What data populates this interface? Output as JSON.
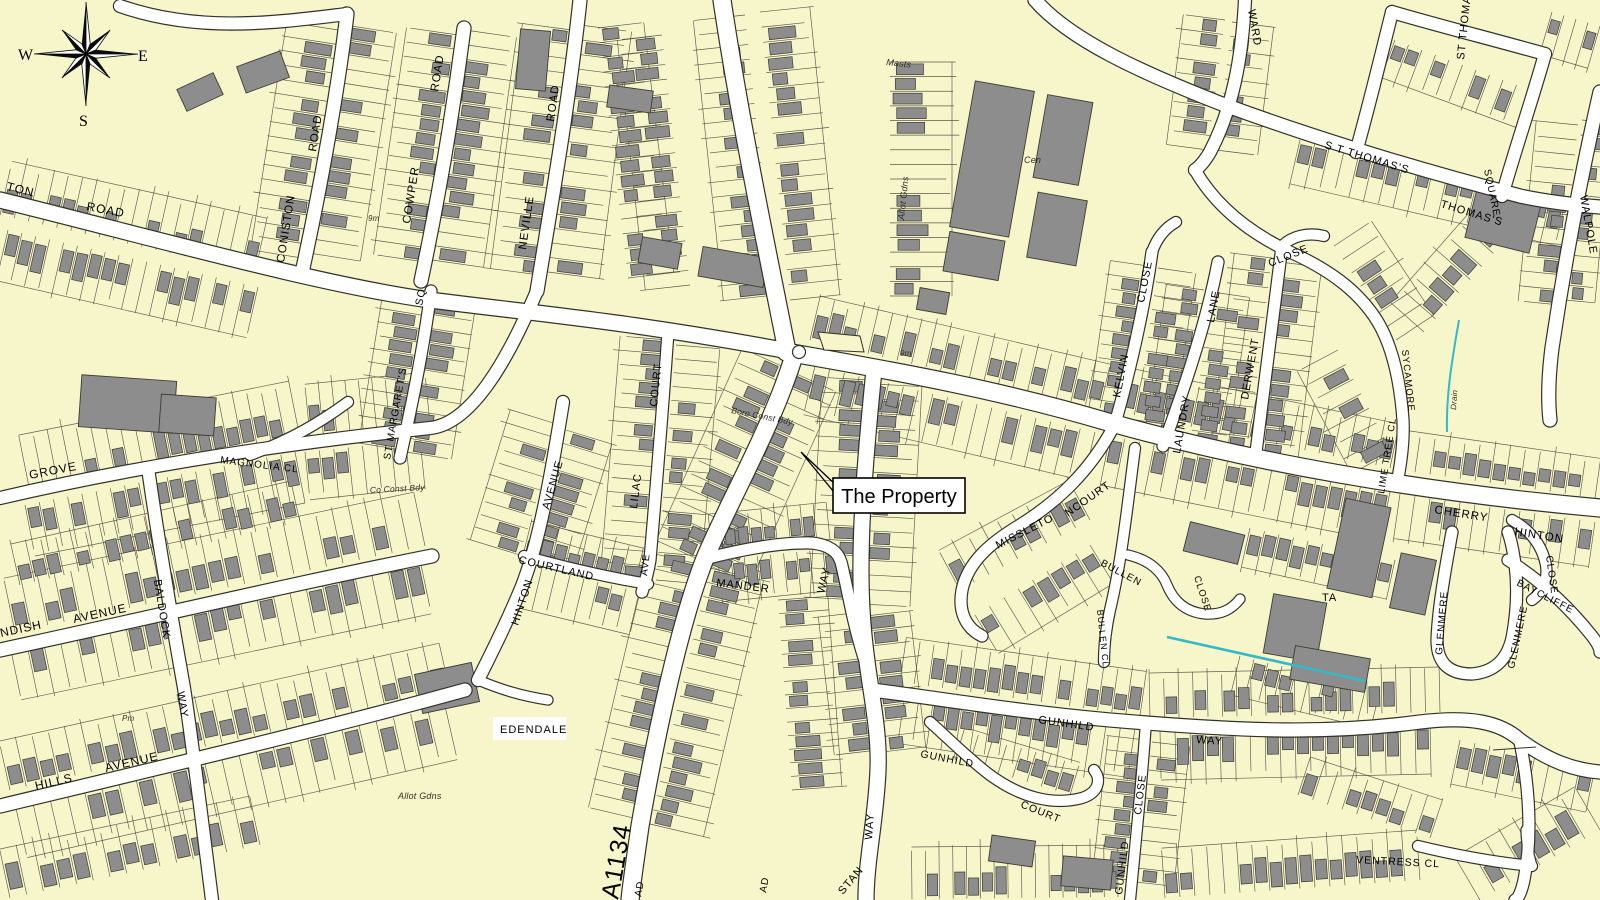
{
  "map": {
    "callout": {
      "text": "The Property"
    },
    "compass": {
      "w": "W",
      "e": "E",
      "s": "S"
    },
    "colors": {
      "background": "#F7F6CB",
      "building": "#8D8D8D",
      "road_fill": "#FFFFFF",
      "line": "#31312A",
      "drain": "#35B8C8",
      "label": "#000000"
    },
    "labels": [
      {
        "text": "TON",
        "x": 6,
        "y": 190,
        "r": 14,
        "s": 12
      },
      {
        "text": "ROAD",
        "x": 86,
        "y": 210,
        "r": 11,
        "s": 12
      },
      {
        "text": "ROAD",
        "x": 316,
        "y": 152,
        "r": -81,
        "s": 11.5
      },
      {
        "text": "CONISTON",
        "x": 284,
        "y": 263,
        "r": -81,
        "s": 11.5
      },
      {
        "text": "ROAD",
        "x": 438,
        "y": 92,
        "r": -81,
        "s": 11.5
      },
      {
        "text": "COWPER",
        "x": 410,
        "y": 224,
        "r": -81,
        "s": 11.5
      },
      {
        "text": "ROAD",
        "x": 554,
        "y": 122,
        "r": -82,
        "s": 11.5
      },
      {
        "text": "NEVILLE",
        "x": 526,
        "y": 250,
        "r": -82,
        "s": 11.5
      },
      {
        "text": "SQ",
        "x": 422,
        "y": 306,
        "r": -78,
        "s": 10.5
      },
      {
        "text": "ST MARGARET'S",
        "x": 390,
        "y": 460,
        "r": -80,
        "s": 10
      },
      {
        "text": "GROVE",
        "x": 30,
        "y": 479,
        "r": -11,
        "s": 12
      },
      {
        "text": "MAGNOLIA CL",
        "x": 220,
        "y": 463,
        "r": 7,
        "s": 10
      },
      {
        "text": "Co Const Bdy",
        "x": 370,
        "y": 493,
        "r": -3,
        "s": 8.5,
        "cls": "note"
      },
      {
        "text": "9m",
        "x": 368,
        "y": 221,
        "r": 0,
        "s": 8,
        "cls": "note"
      },
      {
        "text": "AVENUE",
        "x": 74,
        "y": 623,
        "r": -12,
        "s": 12
      },
      {
        "text": "NDISH",
        "x": 1,
        "y": 637,
        "r": -12,
        "s": 12
      },
      {
        "text": "BALDOCK",
        "x": 154,
        "y": 580,
        "r": 81,
        "s": 11
      },
      {
        "text": "WAY",
        "x": 177,
        "y": 692,
        "r": 81,
        "s": 11
      },
      {
        "text": "HILLS",
        "x": 36,
        "y": 790,
        "r": -13,
        "s": 12
      },
      {
        "text": "AVENUE",
        "x": 106,
        "y": 772,
        "r": -13,
        "s": 12
      },
      {
        "text": "Pm",
        "x": 122,
        "y": 721,
        "r": 0,
        "s": 8,
        "cls": "note"
      },
      {
        "text": "Allot Gdns",
        "x": 398,
        "y": 799,
        "r": 0,
        "s": 9,
        "cls": "note"
      },
      {
        "text": "AVENUE",
        "x": 549,
        "y": 510,
        "r": -74,
        "s": 11
      },
      {
        "text": "HINTON",
        "x": 518,
        "y": 626,
        "r": -72,
        "s": 11
      },
      {
        "text": "COURTLAND",
        "x": 518,
        "y": 563,
        "r": 13,
        "s": 11
      },
      {
        "text": "LILAC",
        "x": 637,
        "y": 509,
        "r": -83,
        "s": 11
      },
      {
        "text": "AVE",
        "x": 647,
        "y": 576,
        "r": -83,
        "s": 10
      },
      {
        "text": "COURT",
        "x": 657,
        "y": 407,
        "r": -84,
        "s": 11,
        "ls": 3
      },
      {
        "text": "MANDER",
        "x": 716,
        "y": 586,
        "r": 7,
        "s": 11
      },
      {
        "text": "WAY",
        "x": 824,
        "y": 594,
        "r": -76,
        "s": 11
      },
      {
        "text": "Boro Const Bdy",
        "x": 731,
        "y": 413,
        "r": 11,
        "s": 8.5,
        "cls": "note"
      },
      {
        "text": "9m",
        "x": 900,
        "y": 356,
        "r": 0,
        "s": 8,
        "cls": "note"
      },
      {
        "text": "A1134",
        "x": 618,
        "y": 900,
        "r": -80,
        "s": 25,
        "cls": "big"
      },
      {
        "text": "AD",
        "x": 641,
        "y": 897,
        "r": -80,
        "s": 10
      },
      {
        "text": "AD",
        "x": 766,
        "y": 893,
        "r": -80,
        "s": 10
      },
      {
        "text": "STAN",
        "x": 843,
        "y": 895,
        "r": -50,
        "s": 11
      },
      {
        "text": "WAY",
        "x": 872,
        "y": 840,
        "r": -86,
        "s": 11,
        "ls": 4
      },
      {
        "text": "GUNHILD",
        "x": 1038,
        "y": 723,
        "r": 8,
        "s": 11
      },
      {
        "text": "WAY",
        "x": 1196,
        "y": 743,
        "r": 4,
        "s": 11
      },
      {
        "text": "GUNHILD",
        "x": 920,
        "y": 757,
        "r": 11,
        "s": 10.5
      },
      {
        "text": "COURT",
        "x": 1020,
        "y": 807,
        "r": 22,
        "s": 10.5,
        "ls": 5
      },
      {
        "text": "CLOSE",
        "x": 1141,
        "y": 815,
        "r": -83,
        "s": 10.5
      },
      {
        "text": "GUNHILD",
        "x": 1122,
        "y": 895,
        "r": -83,
        "s": 10.5
      },
      {
        "text": "BULLEN",
        "x": 1100,
        "y": 565,
        "r": 28,
        "s": 10
      },
      {
        "text": "CLOSE",
        "x": 1194,
        "y": 577,
        "r": 72,
        "s": 9.5,
        "ls": 2
      },
      {
        "text": "BULLEN CL",
        "x": 1097,
        "y": 610,
        "r": 84,
        "s": 9
      },
      {
        "text": "TA",
        "x": 1322,
        "y": 601,
        "r": 0,
        "s": 11
      },
      {
        "text": "MISSLETO",
        "x": 998,
        "y": 549,
        "r": -27,
        "s": 11,
        "ls": 2
      },
      {
        "text": "NCOURT",
        "x": 1068,
        "y": 517,
        "r": -35,
        "s": 11,
        "ls": 2
      },
      {
        "text": "KELVIN",
        "x": 1120,
        "y": 398,
        "r": -79,
        "s": 11
      },
      {
        "text": "CLOSE",
        "x": 1144,
        "y": 303,
        "r": -79,
        "s": 11
      },
      {
        "text": "LAUNDRY",
        "x": 1180,
        "y": 454,
        "r": -80,
        "s": 11
      },
      {
        "text": "LANE",
        "x": 1214,
        "y": 323,
        "r": -80,
        "s": 11
      },
      {
        "text": "DERWENT",
        "x": 1248,
        "y": 400,
        "r": -80,
        "s": 11
      },
      {
        "text": "CLOSE",
        "x": 1270,
        "y": 267,
        "r": -22,
        "s": 11
      },
      {
        "text": "Masts",
        "x": 886,
        "y": 65,
        "r": 6,
        "s": 9,
        "cls": "note"
      },
      {
        "text": "Allot Gdns",
        "x": 904,
        "y": 220,
        "r": -84,
        "s": 9,
        "cls": "note"
      },
      {
        "text": "Cen",
        "x": 1024,
        "y": 163,
        "r": 0,
        "s": 9,
        "cls": "note"
      },
      {
        "text": "WARD",
        "x": 1248,
        "y": 10,
        "r": 80,
        "s": 11
      },
      {
        "text": "ST THOMAS'S",
        "x": 1464,
        "y": 60,
        "r": -84,
        "s": 11
      },
      {
        "text": "S T  THOMAS'S",
        "x": 1324,
        "y": 148,
        "r": 17,
        "s": 11,
        "ls": 1
      },
      {
        "text": "SQUARE",
        "x": 1484,
        "y": 170,
        "r": 78,
        "s": 10
      },
      {
        "text": "THOMAS'S",
        "x": 1440,
        "y": 207,
        "r": 17,
        "s": 11
      },
      {
        "text": "WALPOLE",
        "x": 1580,
        "y": 196,
        "r": 80,
        "s": 11
      },
      {
        "text": "CHERRY",
        "x": 1434,
        "y": 513,
        "r": 9,
        "s": 11.5
      },
      {
        "text": "HINTON",
        "x": 1514,
        "y": 535,
        "r": 9,
        "s": 11.5
      },
      {
        "text": "CLOSE",
        "x": 1546,
        "y": 556,
        "r": 82,
        "s": 10
      },
      {
        "text": "GLENMERE",
        "x": 1442,
        "y": 655,
        "r": -85,
        "s": 10
      },
      {
        "text": "GLENMERE",
        "x": 1514,
        "y": 669,
        "r": -78,
        "s": 10
      },
      {
        "text": "BAYCLIFFE",
        "x": 1516,
        "y": 585,
        "r": 27,
        "s": 10,
        "ls": 3
      },
      {
        "text": "LIME TREE CL",
        "x": 1384,
        "y": 494,
        "r": -81,
        "s": 9.5
      },
      {
        "text": "SYCAMORE",
        "x": 1402,
        "y": 350,
        "r": 84,
        "s": 9.5
      },
      {
        "text": "Drain",
        "x": 1456,
        "y": 410,
        "r": -86,
        "s": 8,
        "cls": "note"
      },
      {
        "text": "VENTRESS CL",
        "x": 1356,
        "y": 863,
        "r": 3,
        "s": 10.5
      },
      {
        "text": "EDENDALE",
        "x": 500,
        "y": 733,
        "r": 0,
        "s": 11,
        "cls": "boxed"
      }
    ]
  }
}
